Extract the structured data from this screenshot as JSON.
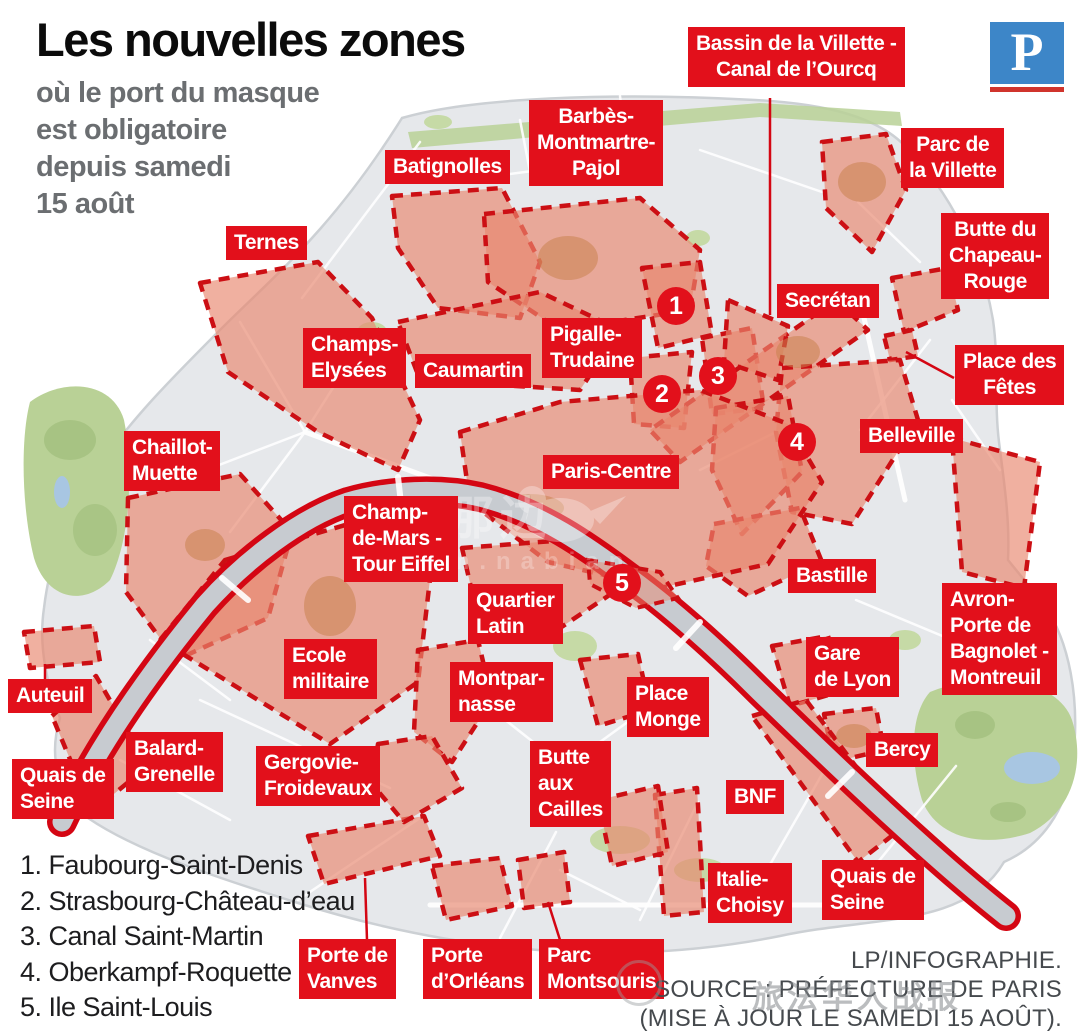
{
  "header": {
    "title": "Les nouvelles zones",
    "subtitle_lines": [
      "où le port du masque",
      "est obligatoire",
      "depuis samedi",
      "15 août"
    ],
    "logo_letter": "P"
  },
  "colors": {
    "label_red": "#e2101b",
    "zone_fill": "#e8876f",
    "zone_border": "#cc0f14",
    "river_red": "#d40613",
    "logo_blue": "#3d86c8",
    "logo_underline": "#d0342c",
    "city_gray": "#e6e8eb",
    "park_green": "#b9d196"
  },
  "map": {
    "zone_labels": [
      {
        "id": "bassin-villette",
        "lines": [
          "Bassin de la Villette -",
          "Canal de l’Ourcq"
        ],
        "x": 688,
        "y": 27,
        "align": "center"
      },
      {
        "id": "barbes-montmartre-pajol",
        "lines": [
          "Barbès-",
          "Montmartre-",
          "Pajol"
        ],
        "x": 529,
        "y": 100,
        "align": "center"
      },
      {
        "id": "batignolles",
        "lines": [
          "Batignolles"
        ],
        "x": 385,
        "y": 150,
        "align": "left"
      },
      {
        "id": "parc-de-la-villette",
        "lines": [
          "Parc de",
          "la Villette"
        ],
        "x": 901,
        "y": 128,
        "align": "center"
      },
      {
        "id": "ternes",
        "lines": [
          "Ternes"
        ],
        "x": 226,
        "y": 226,
        "align": "left"
      },
      {
        "id": "butte-du-chapeau-rouge",
        "lines": [
          "Butte du",
          "Chapeau-",
          "Rouge"
        ],
        "x": 941,
        "y": 213,
        "align": "center"
      },
      {
        "id": "secretan",
        "lines": [
          "Secrétan"
        ],
        "x": 777,
        "y": 284,
        "align": "left"
      },
      {
        "id": "champs-elysees",
        "lines": [
          "Champs-",
          "Elysées"
        ],
        "x": 303,
        "y": 328,
        "align": "left"
      },
      {
        "id": "caumartin",
        "lines": [
          "Caumartin"
        ],
        "x": 415,
        "y": 354,
        "align": "left"
      },
      {
        "id": "pigalle-trudaine",
        "lines": [
          "Pigalle-",
          "Trudaine"
        ],
        "x": 542,
        "y": 318,
        "align": "left"
      },
      {
        "id": "place-des-fetes",
        "lines": [
          "Place des",
          "Fêtes"
        ],
        "x": 955,
        "y": 345,
        "align": "center"
      },
      {
        "id": "belleville",
        "lines": [
          "Belleville"
        ],
        "x": 860,
        "y": 419,
        "align": "left"
      },
      {
        "id": "chaillot-muette",
        "lines": [
          "Chaillot-",
          "Muette"
        ],
        "x": 124,
        "y": 431,
        "align": "left"
      },
      {
        "id": "paris-centre",
        "lines": [
          "Paris-Centre"
        ],
        "x": 543,
        "y": 455,
        "align": "left"
      },
      {
        "id": "champ-de-mars-tour-eiffel",
        "lines": [
          "Champ-",
          "de-Mars -",
          "Tour Eiffel"
        ],
        "x": 344,
        "y": 496,
        "align": "left"
      },
      {
        "id": "bastille",
        "lines": [
          "Bastille"
        ],
        "x": 788,
        "y": 559,
        "align": "left"
      },
      {
        "id": "avron-porte-de-bagnolet-montreuil",
        "lines": [
          "Avron-",
          "Porte de",
          "Bagnolet -",
          "Montreuil"
        ],
        "x": 942,
        "y": 583,
        "align": "left"
      },
      {
        "id": "quartier-latin",
        "lines": [
          "Quartier",
          "Latin"
        ],
        "x": 468,
        "y": 584,
        "align": "left"
      },
      {
        "id": "ecole-militaire",
        "lines": [
          "Ecole",
          "militaire"
        ],
        "x": 284,
        "y": 639,
        "align": "left"
      },
      {
        "id": "montparnasse",
        "lines": [
          "Montpar-",
          "nasse"
        ],
        "x": 450,
        "y": 662,
        "align": "left"
      },
      {
        "id": "place-monge",
        "lines": [
          "Place",
          "Monge"
        ],
        "x": 627,
        "y": 677,
        "align": "left"
      },
      {
        "id": "gare-de-lyon",
        "lines": [
          "Gare",
          "de Lyon"
        ],
        "x": 806,
        "y": 637,
        "align": "left"
      },
      {
        "id": "auteuil",
        "lines": [
          "Auteuil"
        ],
        "x": 8,
        "y": 679,
        "align": "left"
      },
      {
        "id": "bercy",
        "lines": [
          "Bercy"
        ],
        "x": 866,
        "y": 733,
        "align": "left"
      },
      {
        "id": "balard-grenelle",
        "lines": [
          "Balard-",
          "Grenelle"
        ],
        "x": 126,
        "y": 732,
        "align": "left"
      },
      {
        "id": "gergovie-froidevaux",
        "lines": [
          "Gergovie-",
          "Froidevaux"
        ],
        "x": 256,
        "y": 746,
        "align": "left"
      },
      {
        "id": "butte-aux-cailles",
        "lines": [
          "Butte",
          "aux",
          "Cailles"
        ],
        "x": 530,
        "y": 741,
        "align": "left"
      },
      {
        "id": "bnf",
        "lines": [
          "BNF"
        ],
        "x": 726,
        "y": 780,
        "align": "left"
      },
      {
        "id": "quais-de-seine-ouest",
        "lines": [
          "Quais de",
          "Seine"
        ],
        "x": 12,
        "y": 759,
        "align": "left"
      },
      {
        "id": "quais-de-seine-est",
        "lines": [
          "Quais de",
          "Seine"
        ],
        "x": 822,
        "y": 860,
        "align": "left"
      },
      {
        "id": "italie-choisy",
        "lines": [
          "Italie-",
          "Choisy"
        ],
        "x": 708,
        "y": 863,
        "align": "left"
      },
      {
        "id": "porte-de-vanves",
        "lines": [
          "Porte de",
          "Vanves"
        ],
        "x": 299,
        "y": 939,
        "align": "left"
      },
      {
        "id": "porte-d-orleans",
        "lines": [
          "Porte",
          "d’Orléans"
        ],
        "x": 423,
        "y": 939,
        "align": "left"
      },
      {
        "id": "parc-montsouris",
        "lines": [
          "Parc",
          "Montsouris"
        ],
        "x": 539,
        "y": 939,
        "align": "left"
      }
    ],
    "numbered_markers": [
      {
        "n": "1",
        "x": 676,
        "y": 306
      },
      {
        "n": "2",
        "x": 662,
        "y": 394
      },
      {
        "n": "3",
        "x": 718,
        "y": 376
      },
      {
        "n": "4",
        "x": 797,
        "y": 442
      },
      {
        "n": "5",
        "x": 622,
        "y": 583
      }
    ]
  },
  "legend": {
    "items": [
      {
        "num": "1.",
        "name": "Faubourg-Saint-Denis"
      },
      {
        "num": "2.",
        "name": "Strasbourg-Château-d’eau"
      },
      {
        "num": "3.",
        "name": "Canal Saint-Martin"
      },
      {
        "num": "4.",
        "name": "Oberkampf-Roquette"
      },
      {
        "num": "5.",
        "name": "Ile Saint-Louis"
      }
    ]
  },
  "credits": {
    "lines": [
      "LP/INFOGRAPHIE.",
      "SOURCE : PRÉFECTURE DE PARIS",
      "(MISE À JOUR LE SAMEDI 15 AOÛT)."
    ]
  },
  "watermark": {
    "center_text": "那边",
    "center_subtext": "m.nabian",
    "bottom_text": "旅法华人战报"
  }
}
